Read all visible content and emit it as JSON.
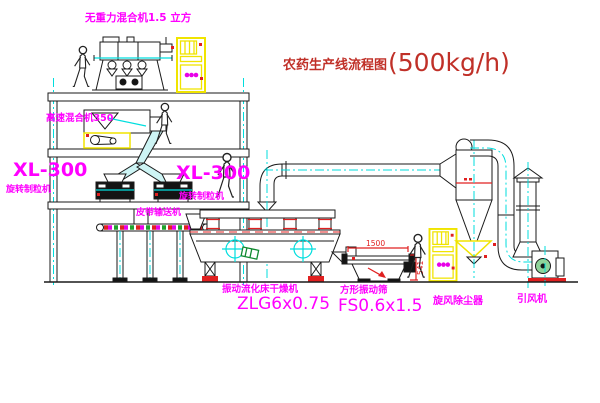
{
  "title": {
    "name_cn": "农药生产线流程图",
    "capacity": "(500kg/h)"
  },
  "equipment_labels": {
    "gravity_mixer": "无重力混合机1.5 立方",
    "high_speed_mixer": "高速混合机350",
    "granulator_left_model": "XL-300",
    "granulator_left_name": "旋转制粒机",
    "granulator_right_model": "XL-300",
    "granulator_right_name": "旋转制粒机",
    "belt_conveyor": "皮带输送机",
    "fluid_bed_dryer_name": "振动流化床干燥机",
    "fluid_bed_dryer_model": "ZLG6x0.75",
    "vibrating_screen_name": "方形振动筛",
    "vibrating_screen_model": "FS0.6x1.5",
    "cyclone_dust_collector": "旋风除尘器",
    "induced_draft_fan": "引风机"
  },
  "dimensions": {
    "screen_length": "1500",
    "screen_height": "541"
  },
  "colors": {
    "label_magenta": "#ff00ff",
    "title_red": "#c03028",
    "dimension_red": "#e02020",
    "centerline_cyan": "#00dede",
    "line_black": "#1a1a1a",
    "cabinet_yellow": "#f0e400"
  }
}
